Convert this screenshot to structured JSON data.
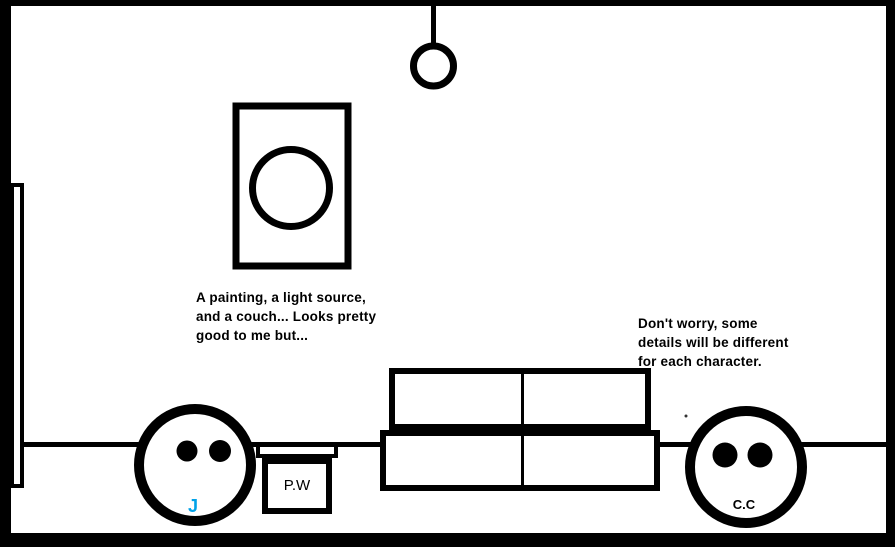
{
  "canvas": {
    "background": "#FFFFFF",
    "ink_color": "#000000"
  },
  "scene_elements": [
    "room-outline",
    "back-wall-line",
    "door",
    "painting",
    "ceiling-light",
    "couch",
    "gift-box",
    "character-face-left",
    "character-face-right",
    "stray-mark"
  ],
  "captions": {
    "left": {
      "lines": [
        "A painting, a light source,",
        "and a couch... Looks pretty",
        "good to me but..."
      ]
    },
    "right": {
      "lines": [
        "Don't worry, some",
        "details will be different",
        "for each character."
      ]
    }
  },
  "labels": {
    "character_left": {
      "text": "J",
      "color": "#00A2E8"
    },
    "box": {
      "text": "P.W",
      "color": "#000000"
    },
    "character_right": {
      "text": "C.C",
      "color": "#000000"
    }
  }
}
